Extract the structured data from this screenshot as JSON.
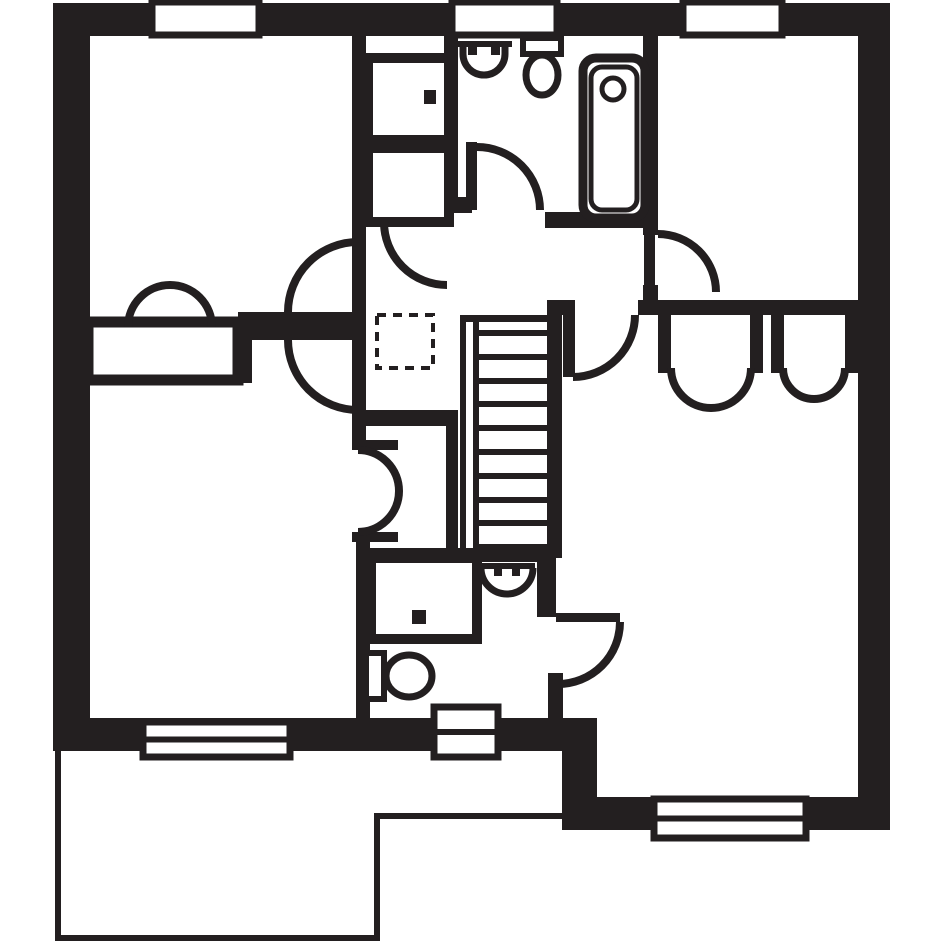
{
  "canvas": {
    "width": 945,
    "height": 945,
    "background": "#ffffff",
    "ink": "#231f20"
  },
  "floorplan": {
    "exterior_walls": [
      {
        "name": "top-wall",
        "shape": "rect",
        "x": 53,
        "y": 3,
        "w": 837,
        "h": 33
      },
      {
        "name": "left-wall",
        "shape": "rect",
        "x": 53,
        "y": 3,
        "w": 37,
        "h": 748
      },
      {
        "name": "right-wall",
        "shape": "rect",
        "x": 858,
        "y": 3,
        "w": 32,
        "h": 827
      },
      {
        "name": "bottom-wall-west",
        "shape": "rect",
        "x": 53,
        "y": 718,
        "w": 544,
        "h": 33
      },
      {
        "name": "step-wall",
        "shape": "rect",
        "x": 562,
        "y": 718,
        "w": 35,
        "h": 112
      },
      {
        "name": "bottom-wall-east",
        "shape": "rect",
        "x": 562,
        "y": 797,
        "w": 328,
        "h": 33
      }
    ],
    "interior_walls": [
      {
        "name": "bedroom2-east-wall",
        "shape": "rect",
        "x": 352,
        "y": 36,
        "w": 14,
        "h": 414
      },
      {
        "name": "bedroom2-bedroom3-wall",
        "shape": "rect",
        "x": 238,
        "y": 312,
        "w": 128,
        "h": 28
      },
      {
        "name": "bedroom3-wall-connector",
        "shape": "rect",
        "x": 238,
        "y": 340,
        "w": 14,
        "h": 43
      },
      {
        "name": "bedroom2-bottom-wall",
        "shape": "rect",
        "x": 88,
        "y": 370,
        "w": 155,
        "h": 13
      },
      {
        "name": "closet-top-wall",
        "shape": "rect",
        "x": 352,
        "y": 410,
        "w": 106,
        "h": 16
      },
      {
        "name": "closet-right-wall",
        "shape": "rect",
        "x": 446,
        "y": 410,
        "w": 12,
        "h": 146
      },
      {
        "name": "closet-jamb-top",
        "shape": "rect",
        "x": 352,
        "y": 440,
        "w": 46,
        "h": 10
      },
      {
        "name": "closet-jamb-bottom",
        "shape": "rect",
        "x": 352,
        "y": 532,
        "w": 46,
        "h": 10
      },
      {
        "name": "ensuite-west-wall",
        "shape": "rect",
        "x": 356,
        "y": 532,
        "w": 14,
        "h": 186
      },
      {
        "name": "ensuite-north-wall",
        "shape": "rect",
        "x": 356,
        "y": 548,
        "w": 200,
        "h": 14
      },
      {
        "name": "ensuite-east-wall",
        "shape": "rect",
        "x": 537,
        "y": 548,
        "w": 19,
        "h": 69
      },
      {
        "name": "ensuite-door-stub",
        "shape": "rect",
        "x": 548,
        "y": 673,
        "w": 15,
        "h": 45
      },
      {
        "name": "stairs-right-wall",
        "shape": "rect",
        "x": 547,
        "y": 300,
        "w": 15,
        "h": 258
      },
      {
        "name": "landing-wall-stub",
        "shape": "rect",
        "x": 555,
        "y": 300,
        "w": 20,
        "h": 15
      },
      {
        "name": "bedrooms-divider-wall",
        "shape": "rect",
        "x": 638,
        "y": 300,
        "w": 252,
        "h": 15
      },
      {
        "name": "bedroom-tr-west-wall",
        "shape": "rect",
        "x": 643,
        "y": 3,
        "w": 15,
        "h": 232
      },
      {
        "name": "bedroom-tr-hinge-block",
        "shape": "rect",
        "x": 643,
        "y": 285,
        "w": 15,
        "h": 30
      },
      {
        "name": "bathroom-south-stub",
        "shape": "rect",
        "x": 447,
        "y": 197,
        "w": 25,
        "h": 16
      },
      {
        "name": "bathroom-south-wall",
        "shape": "rect",
        "x": 545,
        "y": 212,
        "w": 98,
        "h": 16
      },
      {
        "name": "bathroom-west-wall",
        "shape": "rect",
        "x": 444,
        "y": 36,
        "w": 14,
        "h": 177
      },
      {
        "name": "wardrobe-jamb-a",
        "shape": "rect",
        "x": 658,
        "y": 315,
        "w": 13,
        "h": 58
      },
      {
        "name": "wardrobe-jamb-b",
        "shape": "rect",
        "x": 750,
        "y": 315,
        "w": 13,
        "h": 58
      },
      {
        "name": "wardrobe-jamb-c",
        "shape": "rect",
        "x": 771,
        "y": 315,
        "w": 13,
        "h": 58
      },
      {
        "name": "wardrobe-jamb-d",
        "shape": "rect",
        "x": 845,
        "y": 315,
        "w": 13,
        "h": 58
      },
      {
        "name": "stairs-top-edge",
        "shape": "rect",
        "x": 460,
        "y": 315,
        "w": 102,
        "h": 7
      }
    ],
    "roof_outline": [
      {
        "name": "lower-roof-left-line",
        "shape": "rect",
        "x": 55,
        "y": 751,
        "w": 6,
        "h": 190
      },
      {
        "name": "lower-roof-bottom-line",
        "shape": "rect",
        "x": 55,
        "y": 935,
        "w": 325,
        "h": 6
      },
      {
        "name": "lower-roof-right-line",
        "shape": "rect",
        "x": 374,
        "y": 815,
        "w": 6,
        "h": 126
      },
      {
        "name": "lower-roof-top-line",
        "shape": "rect",
        "x": 374,
        "y": 813,
        "w": 188,
        "h": 6
      }
    ],
    "windows": [
      {
        "name": "window-top-left",
        "x": 152,
        "y": 2,
        "w": 107,
        "h": 33,
        "midline": false
      },
      {
        "name": "window-top-middle",
        "x": 452,
        "y": 2,
        "w": 105,
        "h": 33,
        "midline": false
      },
      {
        "name": "window-top-right",
        "x": 683,
        "y": 2,
        "w": 99,
        "h": 33,
        "midline": false
      },
      {
        "name": "window-bottom-left",
        "x": 143,
        "y": 722,
        "w": 147,
        "h": 35,
        "midline": true
      },
      {
        "name": "window-bottom-middle",
        "x": 434,
        "y": 707,
        "w": 64,
        "h": 50,
        "midline": true
      },
      {
        "name": "window-bottom-right",
        "x": 654,
        "y": 799,
        "w": 152,
        "h": 39,
        "midline": true
      }
    ],
    "boxes": [
      {
        "name": "bedroom2-wardrobe-box",
        "x": 88,
        "y": 322,
        "w": 150,
        "h": 58,
        "sw": 11,
        "dashed": false
      },
      {
        "name": "airing-cupboard-box",
        "x": 368,
        "y": 58,
        "w": 81,
        "h": 82,
        "sw": 10,
        "dashed": false
      },
      {
        "name": "landing-cupboard-box",
        "x": 368,
        "y": 148,
        "w": 81,
        "h": 74,
        "sw": 10,
        "dashed": false
      },
      {
        "name": "shower-enclosure-box",
        "x": 371,
        "y": 558,
        "w": 106,
        "h": 81,
        "sw": 10,
        "dashed": false
      },
      {
        "name": "loft-hatch",
        "x": 377,
        "y": 315,
        "w": 56,
        "h": 53,
        "sw": 4,
        "dashed": true
      }
    ],
    "door_leaves": [
      {
        "name": "bathroom-door-leaf",
        "shape": "rect",
        "x": 466,
        "y": 142,
        "w": 11,
        "h": 68
      },
      {
        "name": "bedroom-tr-door-leaf",
        "shape": "rect",
        "x": 644,
        "y": 232,
        "w": 11,
        "h": 60
      },
      {
        "name": "bedroom1-door-leaf",
        "shape": "rect",
        "x": 563,
        "y": 315,
        "w": 12,
        "h": 62
      },
      {
        "name": "ensuite-door-leaf",
        "shape": "rect",
        "x": 556,
        "y": 613,
        "w": 64,
        "h": 9
      }
    ],
    "door_arcs": [
      {
        "name": "bathroom-door-arc",
        "d": "M 477 147 A 63 63 0 0 1 540 210",
        "sw": 8
      },
      {
        "name": "cupboard-door-arc",
        "d": "M 384 222 A 63 63 0 0 0 447 285",
        "sw": 8
      },
      {
        "name": "bedroom2-door-arc",
        "d": "M 358 242 A 70 70 0 0 0 288 312",
        "sw": 8
      },
      {
        "name": "bedroom3-door-arc",
        "d": "M 288 340 A 70 70 0 0 0 358 410",
        "sw": 8
      },
      {
        "name": "bedroom-tr-door-arc",
        "d": "M 658 234 A 58 58 0 0 1 716 292",
        "sw": 8
      },
      {
        "name": "bedroom1-door-arc",
        "d": "M 635 315 A 62 62 0 0 1 573 377",
        "sw": 8
      },
      {
        "name": "ensuite-door-arc",
        "d": "M 620 622 A 62 62 0 0 1 558 684",
        "sw": 8
      }
    ],
    "wardrobe_arcs": [
      {
        "name": "closet-door-arc-top",
        "d": "M 358 450 A 41 41 0 0 1 399 491",
        "sw": 8
      },
      {
        "name": "closet-door-arc-bottom",
        "d": "M 399 491 A 41 41 0 0 1 358 532",
        "sw": 8
      },
      {
        "name": "bedroom2-wardrobe-arc-left",
        "d": "M 128 327 A 42 42 0 0 1 170 285",
        "sw": 8
      },
      {
        "name": "bedroom2-wardrobe-arc-right",
        "d": "M 170 285 A 42 42 0 0 1 212 327",
        "sw": 8
      },
      {
        "name": "bedroom1-wardrobe1-arc-left",
        "d": "M 671 368 A 40 40 0 0 0 711 408",
        "sw": 8
      },
      {
        "name": "bedroom1-wardrobe1-arc-right",
        "d": "M 711 408 A 40 40 0 0 0 751 368",
        "sw": 8
      },
      {
        "name": "bedroom1-wardrobe2-arc-left",
        "d": "M 783 368 A 31 31 0 0 0 814 399",
        "sw": 8
      },
      {
        "name": "bedroom1-wardrobe2-arc-right",
        "d": "M 814 399 A 31 31 0 0 0 845 368",
        "sw": 8
      }
    ],
    "dots": [
      {
        "name": "cylinder-dot",
        "shape": "rect",
        "x": 424,
        "y": 90,
        "w": 12,
        "h": 14
      },
      {
        "name": "shower-handle-dot",
        "shape": "rect",
        "x": 412,
        "y": 610,
        "w": 14,
        "h": 14
      }
    ],
    "stairs": {
      "name": "staircase",
      "rails": [
        {
          "name": "stairs-left-outer-rail",
          "x": 460,
          "y": 315,
          "w": 6,
          "h": 243
        },
        {
          "name": "stairs-left-inner-rail",
          "x": 473,
          "y": 315,
          "w": 6,
          "h": 243
        }
      ],
      "treads": {
        "x": 479,
        "w": 68,
        "y0": 330,
        "step": 23.8,
        "count": 10,
        "h": 6
      }
    },
    "fixtures": [
      {
        "name": "bathroom-sink-rim",
        "shape": "path",
        "d": "M 456 44 L 512 44",
        "sw": 6
      },
      {
        "name": "bathroom-sink-bowl",
        "shape": "path",
        "d": "M 463 46 L 463 54 A 21 21 0 0 0 505 54 L 505 46",
        "sw": 7
      },
      {
        "name": "bathroom-sink-tap-left",
        "shape": "rectfill",
        "x": 468,
        "y": 46,
        "w": 9,
        "h": 9
      },
      {
        "name": "bathroom-sink-tap-right",
        "shape": "rectfill",
        "x": 491,
        "y": 46,
        "w": 9,
        "h": 9
      },
      {
        "name": "bathroom-toilet-cistern",
        "shape": "rectoutline",
        "x": 523,
        "y": 38,
        "w": 38,
        "h": 16,
        "sw": 6
      },
      {
        "name": "bathroom-toilet-bowl",
        "shape": "ellipse",
        "cx": 542,
        "cy": 75,
        "rx": 16,
        "ry": 20,
        "sw": 7
      },
      {
        "name": "bathtub-outer",
        "shape": "rectoutline",
        "x": 583,
        "y": 58,
        "w": 62,
        "h": 160,
        "rx": 13,
        "sw": 9
      },
      {
        "name": "bathtub-inner",
        "shape": "rectoutline",
        "x": 591,
        "y": 67,
        "w": 46,
        "h": 143,
        "rx": 11,
        "sw": 5
      },
      {
        "name": "bathtub-drain",
        "shape": "ellipse",
        "cx": 613,
        "cy": 89,
        "rx": 11,
        "ry": 11,
        "sw": 5
      },
      {
        "name": "ensuite-sink-rim",
        "shape": "path",
        "d": "M 479 566 L 535 566",
        "sw": 6
      },
      {
        "name": "ensuite-sink-bowl",
        "shape": "path",
        "d": "M 481 568 A 26 26 0 0 0 533 568",
        "sw": 7
      },
      {
        "name": "ensuite-sink-tap-left",
        "shape": "rectfill",
        "x": 494,
        "y": 568,
        "w": 8,
        "h": 8
      },
      {
        "name": "ensuite-sink-tap-right",
        "shape": "rectfill",
        "x": 512,
        "y": 568,
        "w": 8,
        "h": 8
      },
      {
        "name": "ensuite-toilet-cistern",
        "shape": "rectoutline",
        "x": 366,
        "y": 653,
        "w": 18,
        "h": 46,
        "sw": 6
      },
      {
        "name": "ensuite-toilet-bowl",
        "shape": "ellipse",
        "cx": 409,
        "cy": 676,
        "rx": 23,
        "ry": 21,
        "sw": 7
      }
    ]
  }
}
